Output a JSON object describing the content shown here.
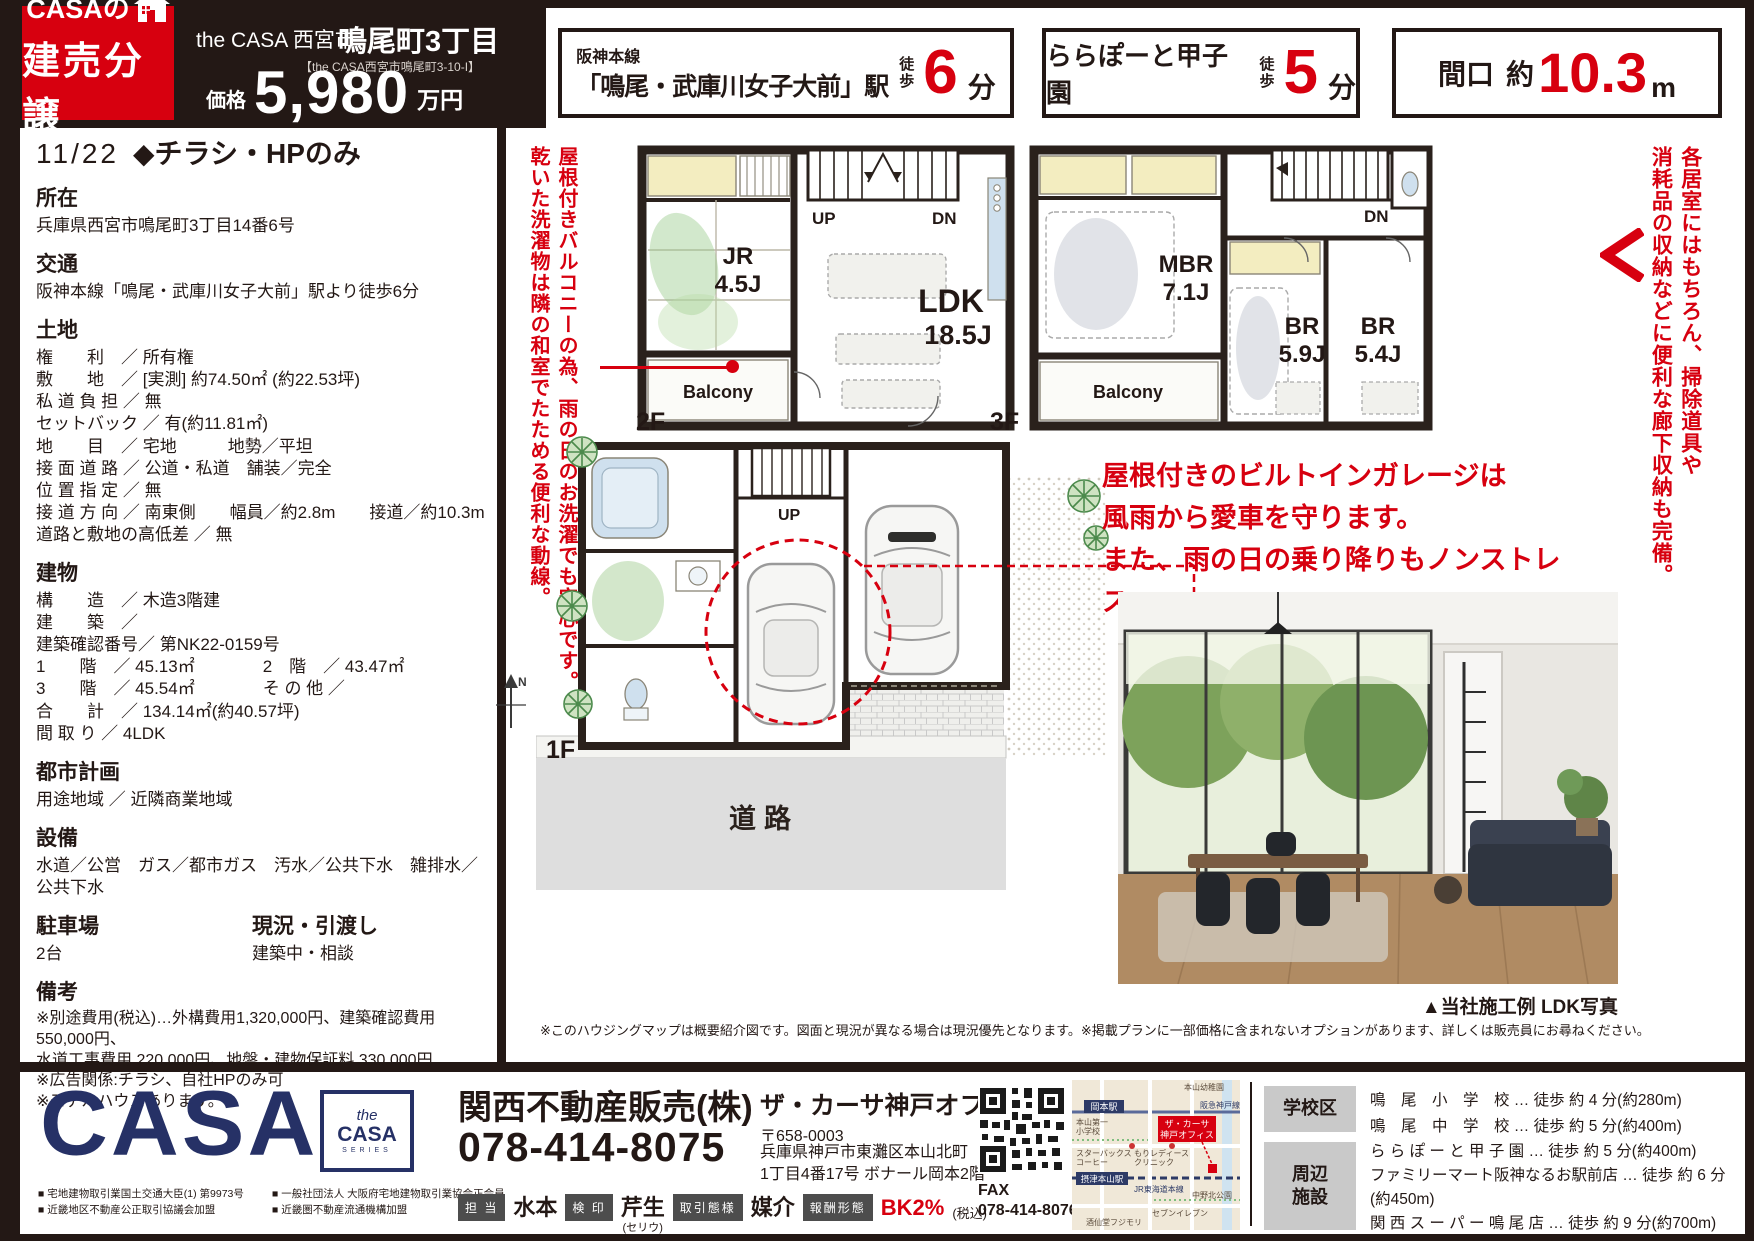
{
  "header": {
    "logo_line1": "CASAの",
    "logo_line2": "建売分譲",
    "series": "the CASA 西宮市",
    "title": "鳴尾町3丁目",
    "subtitle": "【the CASA西宮市鳴尾町3-10-I】",
    "price_label": "価格",
    "price_value": "5,980",
    "price_unit": "万円"
  },
  "badges": {
    "b1_line1": "阪神本線",
    "b1_line2": "「鳴尾・武庫川女子大前」駅",
    "b1_walk": "徒歩",
    "b1_num": "6",
    "b1_unit": "分",
    "b2_main": "ららぽーと甲子園",
    "b2_walk": "徒歩",
    "b2_num": "5",
    "b2_unit": "分",
    "b3_label": "間口",
    "b3_approx": "約",
    "b3_num": "10.3",
    "b3_unit": "m"
  },
  "left": {
    "date": "11/22",
    "flag": "◆チラシ・HPのみ",
    "s1h": "所在",
    "s1b": "兵庫県西宮市鳴尾町3丁目14番6号",
    "s2h": "交通",
    "s2b": "阪神本線「鳴尾・武庫川女子大前」駅より徒歩6分",
    "s3h": "土地",
    "s3b": "権　　利　／ 所有権\n敷　　地　／ [実測] 約74.50㎡ (約22.53坪)\n私 道 負 担 ／ 無\nセットバック ／ 有(約11.81㎡)\n地　　目　／ 宅地　　　地勢／平坦\n接 面 道 路 ／ 公道・私道　舗装／完全\n位 置 指 定 ／ 無\n接 道 方 向 ／ 南東側　　幅員／約2.8m　　接道／約10.3m\n道路と敷地の高低差 ／ 無",
    "s4h": "建物",
    "s4b": "構　　造　／ 木造3階建\n建　　築　／\n建築確認番号／ 第NK22-0159号\n1　　階　／ 45.13㎡　　　　2　階　／ 43.47㎡\n3　　階　／ 45.54㎡　　　　そ の 他 ／\n合　　計　／ 134.14㎡(約40.57坪)\n間 取 り ／ 4LDK",
    "s5h": "都市計画",
    "s5b": "用途地域 ／ 近隣商業地域",
    "s6h": "設備",
    "s6b": "水道／公営　ガス／都市ガス　汚水／公共下水　雑排水／公共下水",
    "s7h": "駐車場",
    "s7b": "2台",
    "s7h2": "現況・引渡し",
    "s7b2": "建築中・相談",
    "s8h": "備考",
    "s8b": "※別途費用(税込)…外構費用1,320,000円、建築確認費用550,000円、\n水道工事費用 220,000円、地盤・建物保証料 330,000円\n※広告関係:チラシ、自社HPのみ可\n※モデルハウスあります。"
  },
  "annot": {
    "left_v1": "屋根付きバルコニーの為、雨の日のお洗濯でも安心です。",
    "left_v2": "乾いた洗濯物は隣の和室でたためる便利な動線。",
    "right_v1": "各居室にはもちろん、掃除道具や",
    "right_v2": "消耗品の収納などに便利な廊下収納も完備。",
    "garage": "屋根付きのビルトインガレージは\n風雨から愛車を守ります。\nまた、雨の日の乗り降りもノンストレス。"
  },
  "plans": {
    "f2": {
      "label": "2F",
      "jr": "JR",
      "jr_size": "4.5J",
      "ldk": "LDK",
      "ldk_size": "18.5J",
      "balcony": "Balcony",
      "up": "UP",
      "dn": "DN"
    },
    "f3": {
      "label": "3F",
      "mbr": "MBR",
      "mbr_size": "7.1J",
      "br1": "BR",
      "br1_size": "5.9J",
      "br2": "BR",
      "br2_size": "5.4J",
      "balcony": "Balcony",
      "dn": "DN"
    },
    "f1": {
      "label": "1F",
      "up": "UP",
      "road": "道路",
      "north": "N"
    }
  },
  "photo_caption": "▲当社施工例 LDK写真",
  "disclaimer": "※このハウジングマップは概要紹介図です。図面と現況が異なる場合は現況優先となります。※掲載プランに一部価格に含まれないオプションがあります、詳しくは販売員にお尋ねください。",
  "footer": {
    "logo": "CASA",
    "series_the": "the",
    "series_casa": "CASA",
    "series_sub": "SERIES",
    "lic1": "■ 宅地建物取引業国土交通大臣(1) 第9973号\n■ 近畿地区不動産公正取引協議会加盟",
    "lic2": "■ 一般社団法人 大阪府宅地建物取引業協会正会員\n■ 近畿圏不動産流通機構加盟",
    "company": "関西不動産販売(株)",
    "office": "ザ・カーサ神戸オフィス",
    "phone": "078-414-8075",
    "postal": "〒658-0003",
    "addr": "兵庫県神戸市東灘区本山北町\n1丁目4番17号 ボナール岡本2階",
    "staff1_l": "担 当",
    "staff1_v": "水本",
    "staff2_l": "検 印",
    "staff2_v": "芹生",
    "staff2_s": "(セリウ)",
    "staff3_l": "取引態様",
    "staff3_v": "媒介",
    "staff4_l": "報酬形態",
    "staff4_v": "BK2%",
    "staff4_s": "(税込)",
    "fax_label": "FAX",
    "fax": "078-414-8076",
    "school_label": "学校区",
    "school_lines": "鳴　尾　小　学　校 … 徒歩 約 4 分(約280m)\n鳴　尾　中　学　校 … 徒歩 約 5 分(約400m)",
    "fac_label": "周辺\n施設",
    "fac_lines": "ら ら ぽ ー と 甲 子 園 … 徒歩 約 5 分(約400m)\nファミリーマート阪神なるお駅前店 … 徒歩 約 6 分(約450m)\n関 西 ス ー パ ー 鳴 尾 店 … 徒歩 約 9 分(約700m)\n西 宮 鳴 尾 郵 便 局 … 徒歩 約 4 分(約270m)",
    "map": {
      "rail_top": "阪急神戸線",
      "st_top": "岡本駅",
      "kind": "本山幼稚園",
      "school1": "本山第一",
      "school2": "小学校",
      "office1": "ザ・カーサ",
      "office2": "神戸オフィス",
      "sb1": "スターバックス",
      "sb2": "コーヒー",
      "clinic1": "もりレディース",
      "clinic2": "クリニック",
      "st_mid": "摂津本山駅",
      "rail_mid": "JR東海道本線",
      "park": "中野北公園",
      "seven": "セブンイレブン",
      "sake": "酒仙堂フジモリ"
    }
  }
}
